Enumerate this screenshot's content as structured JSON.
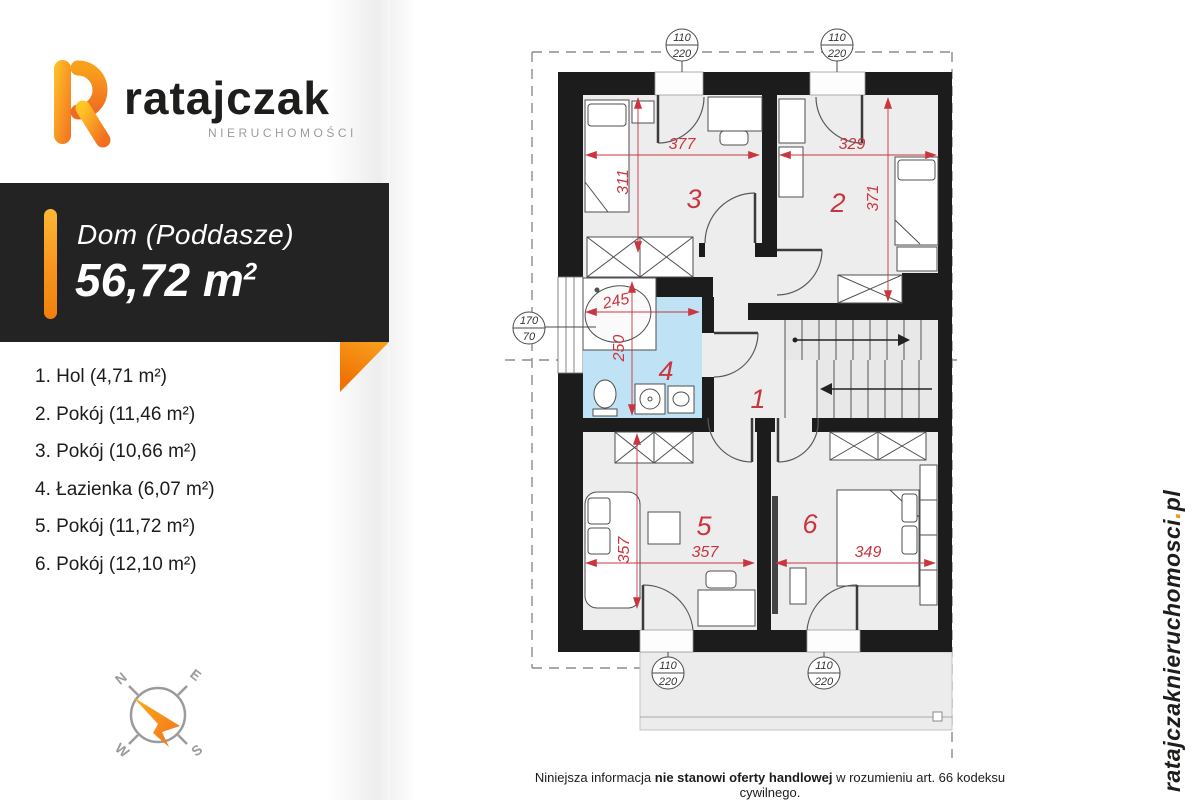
{
  "logo": {
    "brand": "ratajczak",
    "subtitle": "NIERUCHOMOŚCI"
  },
  "card": {
    "title": "Dom (Poddasze)",
    "area_value": "56,72 m",
    "area_exp": "2"
  },
  "room_list": [
    {
      "label": "1. Hol (4,71 m²)"
    },
    {
      "label": "2. Pokój (11,46 m²)"
    },
    {
      "label": "3. Pokój (10,66 m²)"
    },
    {
      "label": "4. Łazienka (6,07 m²)"
    },
    {
      "label": "5. Pokój (11,72 m²)"
    },
    {
      "label": "6. Pokój (12,10 m²)"
    }
  ],
  "compass": {
    "n": "N",
    "e": "E",
    "s": "S",
    "w": "W"
  },
  "plan": {
    "room_numbers": {
      "r1": "1",
      "r2": "2",
      "r3": "3",
      "r4": "4",
      "r5": "5",
      "r6": "6"
    },
    "dimensions": {
      "room3_width": "377",
      "room3_depth": "311",
      "room2_width": "329",
      "room2_depth": "371",
      "bath_width": "245",
      "bath_depth": "250",
      "room5_width": "357",
      "room5_depth": "357",
      "room6_width": "349"
    },
    "window_label": {
      "width": "110",
      "height": "220"
    },
    "side_window_label": {
      "width": "170",
      "height": "70"
    }
  },
  "footer": {
    "text_start": "Niniejsza informacja ",
    "text_bold": "nie stanowi oferty handlowej",
    "text_end": " w rozumieniu art. 66 kodeksu cywilnego."
  },
  "website": {
    "name": "ratajczaknieruchomosci",
    "dot": ".",
    "tld": "pl"
  },
  "colors": {
    "accent_orange": "#f7941e",
    "dim_red": "#c9363f",
    "bath_blue": "#bfe2f4",
    "wall_black": "#1c1c1c"
  }
}
